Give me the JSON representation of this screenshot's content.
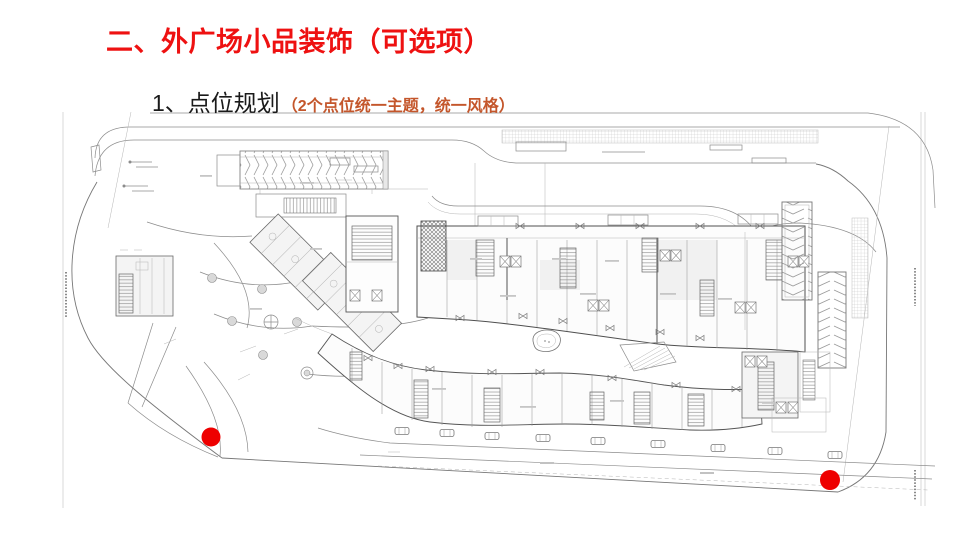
{
  "slide": {
    "title": "二、外广场小品装饰（可选项）",
    "title_color": "#ee1111",
    "subtitle": "1、点位规划",
    "subtitle_color": "#1a1a1a",
    "subtitle_note": "（2个点位统一主题，统一风格）",
    "subtitle_note_color": "#c4562b"
  },
  "plan": {
    "drawing": "commercial-outer-plaza-site-plan",
    "line_color": "#8c8c8c",
    "markers": [
      {
        "id": "point-1-southwest-plaza",
        "x_pct": 21.98,
        "y_pct": 80.93,
        "diameter_px": 19,
        "color": "#ee0000"
      },
      {
        "id": "point-2-southeast-plaza",
        "x_pct": 86.46,
        "y_pct": 88.89,
        "diameter_px": 20,
        "color": "#ee0000"
      }
    ]
  }
}
